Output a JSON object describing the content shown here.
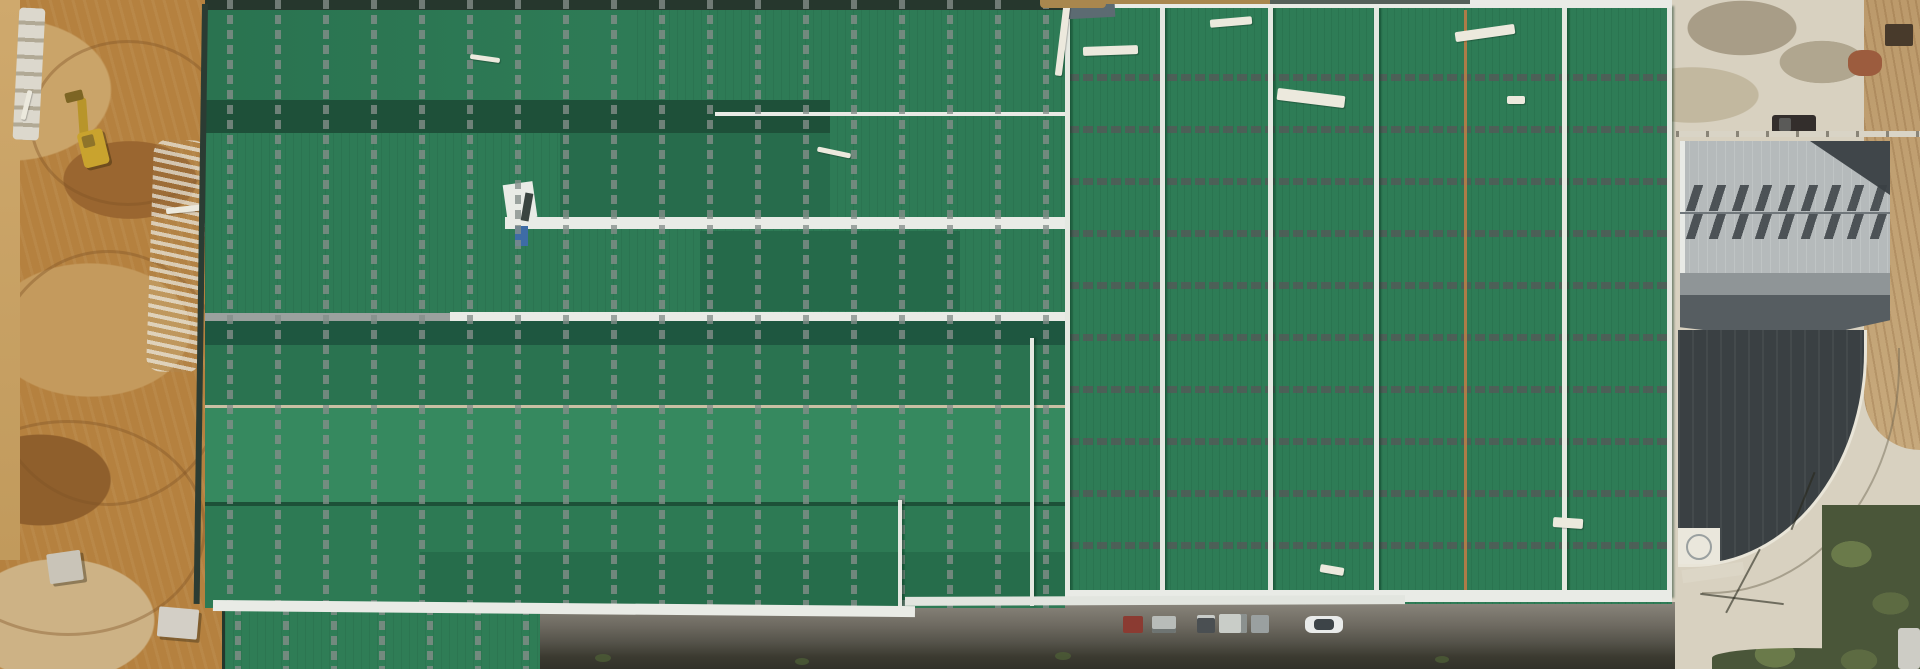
{
  "scene": {
    "type": "aerial-drone-photograph",
    "subject": "Large industrial factory complex under construction, viewed top-down",
    "time_of_day": "daytime, strong sun with shadows cast left/down",
    "visible_text": "none"
  },
  "regions": {
    "construction_dirt_area": {
      "position": "left edge",
      "surface": "excavated brown earth with tire tracks and graded mounds",
      "objects": [
        {
          "name": "wheel-loader-excavator",
          "color": "#c9a32e",
          "state": "parked on dirt, casting shadow"
        },
        {
          "name": "stacked-stone-blocks-row",
          "color": "#dcd8cd"
        },
        {
          "name": "white-rubble-strip",
          "color": "#e8e5da"
        },
        {
          "name": "concrete-debris-blocks",
          "color": "#c9c4b8"
        },
        {
          "name": "white-plank",
          "color": "#ece9dd"
        }
      ],
      "palette": [
        "#b5813f",
        "#caa469",
        "#8f5f2c",
        "#cdb285"
      ]
    },
    "factory_roof_left_wing": {
      "position": "center-left, x~205-1065",
      "structure": "horizontal gable bays, alternating sunlit and shaded green slopes",
      "features": [
        "vertical dashed skylight strips spaced ~48px",
        "dark ridge bands",
        "white ridge cap at mid-height",
        "white roof walkway with roofing machine and blue bin",
        "white eave walkway along bottom edge",
        "two short white vertical ridge caps in lower half"
      ],
      "palette": {
        "lit_green": "#36895f",
        "base_green": "#2e7b56",
        "shaded_green": "#256a4a",
        "dark_band": "#1d523c",
        "walkway_white": "#e9ebe6"
      }
    },
    "factory_roof_right_wing": {
      "position": "center-right, x~1065-1672",
      "structure": "vertical gable bays with white ridge caps",
      "features": [
        "horizontal dashed skylight rows spaced ~52px",
        "white vertical ridge lines ~every 100px",
        "rust-orange seam line",
        "scattered loose white planks and panels",
        "white eave strips top and bottom",
        "white diagonal braces at wing junction"
      ],
      "palette": {
        "base_green": "#2e7c56",
        "ridge_white": "#e4e8e1",
        "rust_seam": "#ad7c48"
      }
    },
    "annex_roof": {
      "position": "bottom-left below main eave",
      "structure": "small green roof section continuing past bottom edge of frame",
      "palette": {
        "green": "#2f7d56"
      }
    },
    "service_road_bottom": {
      "position": "bottom strip",
      "surface": "gray asphalt with dark embankment and grass tufts below",
      "vehicles": [
        {
          "name": "red-box-truck",
          "color": "#8b3b32"
        },
        {
          "name": "gray-container-stack-1",
          "color": "#b8bcb9"
        },
        {
          "name": "dark-container",
          "color": "#4a4f52"
        },
        {
          "name": "light-container-stack",
          "color": "#c9cdc8"
        },
        {
          "name": "gray-container-stack-2",
          "color": "#9aa0a0"
        },
        {
          "name": "white-car",
          "color": "#e9ebea"
        }
      ],
      "palette": [
        "#6e6a61",
        "#3b3a30"
      ]
    },
    "east_yard": {
      "position": "right edge",
      "features": [
        {
          "name": "concrete-apron",
          "color": "#d8d1c0",
          "detail": "wet gray stains"
        },
        {
          "name": "dirt-track-strip",
          "color": "#bc9a6b"
        },
        {
          "name": "dark-storage-object",
          "color": "#483a2b"
        },
        {
          "name": "red-brown-debris-pile",
          "color": "#9c5c3e"
        },
        {
          "name": "dark-pickup-truck",
          "color": "#332e2c"
        },
        {
          "name": "boundary-fence-line",
          "color": "#d9d4c6"
        },
        {
          "name": "gray-warehouse-roof",
          "color": "#b5babb",
          "detail": "two rows of roof-vent shadows, dark corner wedge"
        },
        {
          "name": "charcoal-curved-awning-roof",
          "color": "#3a4043",
          "detail": "white retaining wall along curved outer edge"
        },
        {
          "name": "curved-concrete-road",
          "color": "#cfc5ab"
        },
        {
          "name": "white-tank-structure",
          "color": "#eae7dc"
        },
        {
          "name": "utility-pole-shadows",
          "color": "#28281c"
        },
        {
          "name": "vegetation",
          "color": "#4a5639"
        },
        {
          "name": "white-vehicle-corner",
          "color": "#cdccc5"
        }
      ]
    }
  }
}
